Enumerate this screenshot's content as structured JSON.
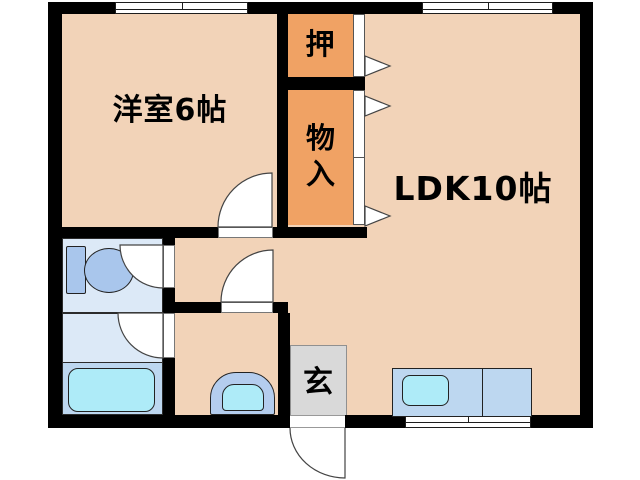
{
  "floorplan": {
    "title": "apartment-floorplan",
    "rooms": {
      "western_room": {
        "label": "洋室6帖"
      },
      "ldk": {
        "label": "LDK10帖"
      },
      "oshiire_closet": {
        "label": "押"
      },
      "storage_closet": {
        "label": "物入"
      },
      "entrance": {
        "label": "玄"
      }
    },
    "fixtures": {
      "toilet": "toilet",
      "bathtub": "bathtub",
      "washbasin": "washbasin",
      "kitchen_counter": "kitchen-counter-with-sink"
    },
    "colors": {
      "room_floor": "#F2D3B8",
      "closet": "#F0A264",
      "wet_room_floor": "#DCE9F7",
      "fixture_blue": "#A9C6EC",
      "counter_blue": "#BDD7F0",
      "water_cyan": "#AEEBF8",
      "entrance_gray": "#D9D9D9",
      "wall": "#000000"
    }
  }
}
